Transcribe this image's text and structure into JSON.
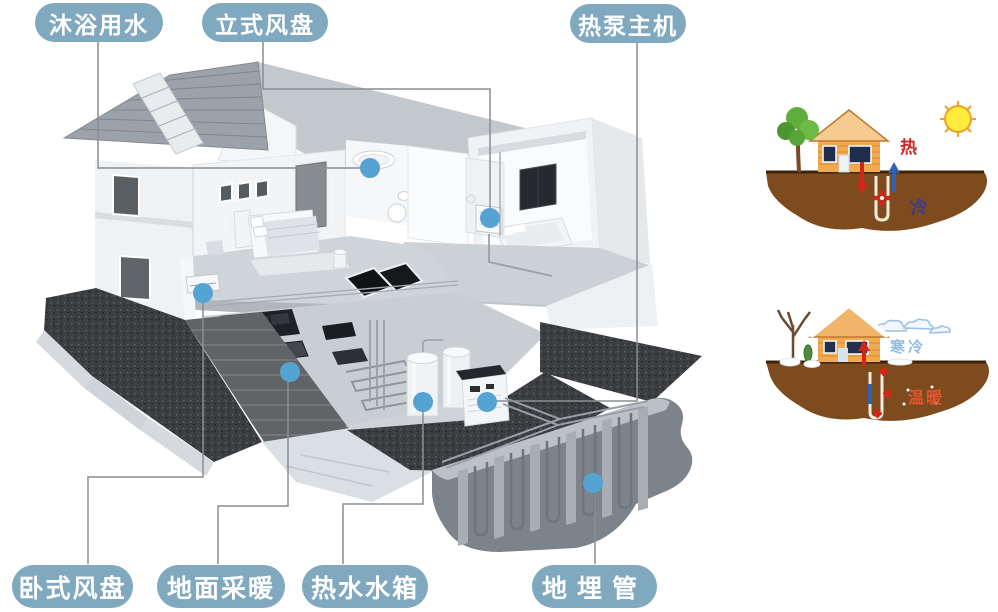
{
  "labels": {
    "bath_water": "沐浴用水",
    "vertical_fan_coil": "立式风盘",
    "heat_pump": "热泵主机",
    "horizontal_fan_coil": "卧式风盘",
    "floor_heating": "地面采暖",
    "hot_water_tank": "热水水箱",
    "buried_pipe": "地埋管"
  },
  "annotations": {
    "summer_hot": "热",
    "summer_cold": "冷",
    "winter_cold": "寒冷",
    "winter_warm": "温暖"
  },
  "colors": {
    "label_bg": "#80a9bf",
    "marker_dot": "#55a3d2",
    "leader_line": "#8a8e92",
    "hot_red": "#cb2626",
    "cold_blue": "#3c3c90",
    "winter_cold_blue": "#93badf",
    "winter_warm_orange": "#e2552e",
    "soil_brown": "#7d4b1d",
    "house_orange": "#f2a950"
  }
}
